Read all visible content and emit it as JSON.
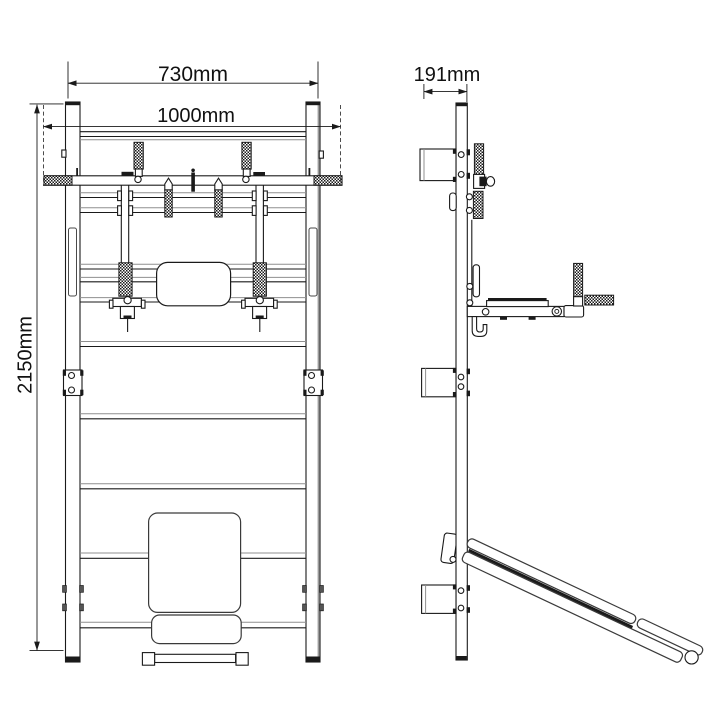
{
  "drawing": {
    "description": "Orthographic technical drawing of wall-mounted wall bars with pull-up bar, dip/backrest unit and fold-out incline bench",
    "views": {
      "front": "front view",
      "side": "side view"
    },
    "dimensions": {
      "top_width": "730mm",
      "overall_width": "1000mm",
      "overall_height": "2150mm",
      "depth": "191mm"
    },
    "colors": {
      "background": "#ffffff",
      "line": "#1a1a1a",
      "secondary_line": "#8f8f8f"
    }
  }
}
